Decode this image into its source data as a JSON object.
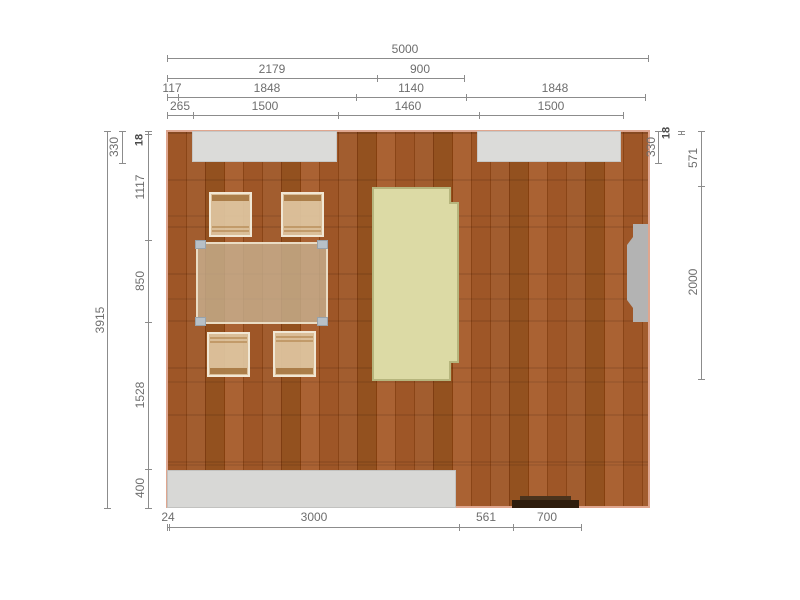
{
  "meta": {
    "view": "floor-plan-with-dimensions",
    "unit": "mm",
    "room": {
      "width_mm": 5000,
      "depth_mm": 3915
    }
  },
  "colors": {
    "floor_wood": "#964e1e",
    "wall_line": "#dfa68f",
    "window_fill": "#dbdbd9",
    "counter_fill": "#d8d8d6",
    "cabinet_fill": "#dcdaa5",
    "cabinet_stroke": "#b6b57d",
    "door_fill": "#b3b3b3",
    "table_fill": "#c9b394",
    "chair_fill": "#e0c7a2",
    "radiator_fill": "#2e1d0d",
    "dimension_line": "#8c8c8c",
    "dimension_text": "#6e6e6e"
  },
  "objects": [
    "window-top-left",
    "window-top-right",
    "dining-table",
    "chair",
    "chair",
    "chair",
    "chair",
    "yellow-cabinet",
    "bottom-counter",
    "radiator",
    "right-wall-door"
  ],
  "dimensions": {
    "chains": [
      {
        "id": "top-overall",
        "orient": "h",
        "x1": 167,
        "x2": 648,
        "y": 58,
        "ticks": [
          167,
          648
        ],
        "labels": [
          {
            "text": "5000",
            "cx": 405,
            "cy": 49
          }
        ]
      },
      {
        "id": "top-row2",
        "orient": "h",
        "x1": 167,
        "x2": 464,
        "y": 78,
        "ticks": [
          167,
          377,
          464
        ],
        "labels": [
          {
            "text": "2179",
            "cx": 272,
            "cy": 69
          },
          {
            "text": "900",
            "cx": 420,
            "cy": 69
          }
        ]
      },
      {
        "id": "top-row3",
        "orient": "h",
        "x1": 167,
        "x2": 645,
        "y": 97,
        "ticks": [
          167,
          178,
          356,
          466,
          645
        ],
        "labels": [
          {
            "text": "117",
            "cx": 172,
            "cy": 88
          },
          {
            "text": "1848",
            "cx": 267,
            "cy": 88
          },
          {
            "text": "1140",
            "cx": 411,
            "cy": 88
          },
          {
            "text": "1848",
            "cx": 555,
            "cy": 88
          }
        ]
      },
      {
        "id": "top-row4",
        "orient": "h",
        "x1": 167,
        "x2": 623,
        "y": 115,
        "ticks": [
          167,
          193,
          338,
          479,
          623
        ],
        "labels": [
          {
            "text": "265",
            "cx": 180,
            "cy": 106
          },
          {
            "text": "1500",
            "cx": 265,
            "cy": 106
          },
          {
            "text": "1460",
            "cx": 408,
            "cy": 106
          },
          {
            "text": "1500",
            "cx": 551,
            "cy": 106
          }
        ]
      },
      {
        "id": "bottom",
        "orient": "h",
        "x1": 167,
        "x2": 581,
        "y": 527,
        "ticks": [
          167,
          169,
          459,
          513,
          581
        ],
        "labels": [
          {
            "text": "24",
            "cx": 168,
            "cy": 517
          },
          {
            "text": "3000",
            "cx": 314,
            "cy": 517
          },
          {
            "text": "561",
            "cx": 486,
            "cy": 517
          },
          {
            "text": "700",
            "cx": 547,
            "cy": 517
          }
        ]
      },
      {
        "id": "left-overall",
        "orient": "v",
        "x": 107,
        "y1": 131,
        "y2": 508,
        "ticks": [
          131,
          508
        ],
        "labels": [
          {
            "text": "3915",
            "cx": 100,
            "cy": 320,
            "rot": true
          }
        ]
      },
      {
        "id": "left-330",
        "orient": "v",
        "x": 122,
        "y1": 131,
        "y2": 163,
        "ticks": [
          131,
          163
        ],
        "labels": [
          {
            "text": "330",
            "cx": 114,
            "cy": 147,
            "rot": true
          }
        ]
      },
      {
        "id": "left-inner",
        "orient": "v",
        "x": 148,
        "y1": 131,
        "y2": 508,
        "ticks": [
          131,
          134,
          240,
          322,
          469,
          508
        ],
        "labels": [
          {
            "text": "18",
            "cx": 140,
            "cy": 140,
            "rot": true,
            "bold": true
          },
          {
            "text": "1117",
            "cx": 140,
            "cy": 187,
            "rot": true
          },
          {
            "text": "850",
            "cx": 140,
            "cy": 281,
            "rot": true
          },
          {
            "text": "1528",
            "cx": 140,
            "cy": 395,
            "rot": true
          },
          {
            "text": "400",
            "cx": 140,
            "cy": 488,
            "rot": true
          }
        ]
      },
      {
        "id": "right-330",
        "orient": "v",
        "x": 658,
        "y1": 131,
        "y2": 163,
        "ticks": [
          131,
          163
        ],
        "labels": [
          {
            "text": "330",
            "cx": 651,
            "cy": 147,
            "rot": true
          }
        ]
      },
      {
        "id": "right-18",
        "orient": "v",
        "x": 681,
        "y1": 131,
        "y2": 134,
        "ticks": [
          131,
          134
        ],
        "labels": [
          {
            "text": "18",
            "cx": 667,
            "cy": 133,
            "rot": true,
            "bold": true
          }
        ]
      },
      {
        "id": "right-inner",
        "orient": "v",
        "x": 701,
        "y1": 131,
        "y2": 379,
        "ticks": [
          131,
          186,
          379
        ],
        "labels": [
          {
            "text": "571",
            "cx": 693,
            "cy": 158,
            "rot": true
          },
          {
            "text": "2000",
            "cx": 693,
            "cy": 282,
            "rot": true
          }
        ]
      }
    ]
  }
}
